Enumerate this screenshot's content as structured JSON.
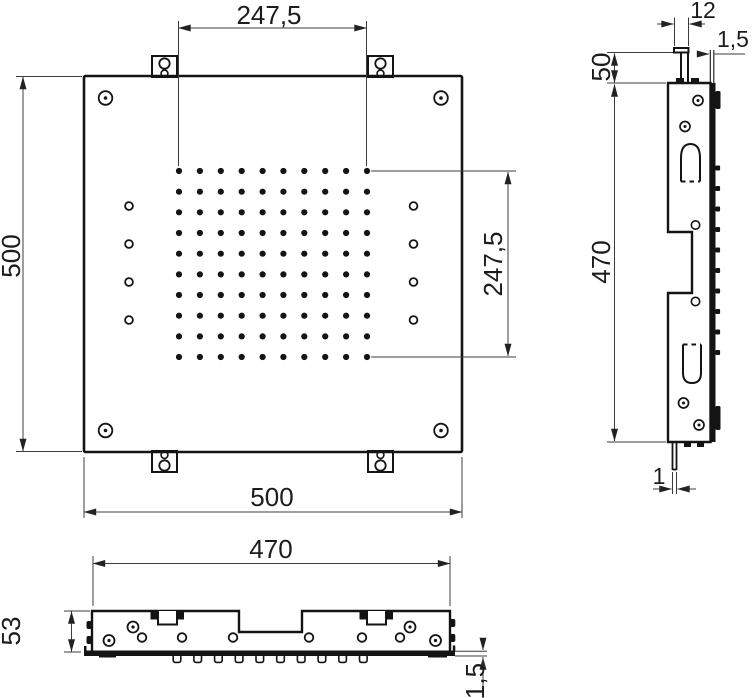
{
  "drawing": {
    "labels": {
      "front_top": "247,5",
      "front_left": "500",
      "front_bottom": "500",
      "front_right": "247,5",
      "side_hook_width": "12",
      "side_plate_thickness": "1,5",
      "side_bracket_offset": "50",
      "side_height": "470",
      "side_flange_thickness": "1",
      "bottom_width": "470",
      "bottom_depth": "53",
      "bottom_plate_thickness": "1,5"
    },
    "nozzles": {
      "grid_rows": 10,
      "grid_cols": 10,
      "side_profile_nub_count": 10,
      "bottom_profile_nub_count": 10
    },
    "colors": {
      "line": "#141414",
      "background": "#ffffff"
    }
  }
}
